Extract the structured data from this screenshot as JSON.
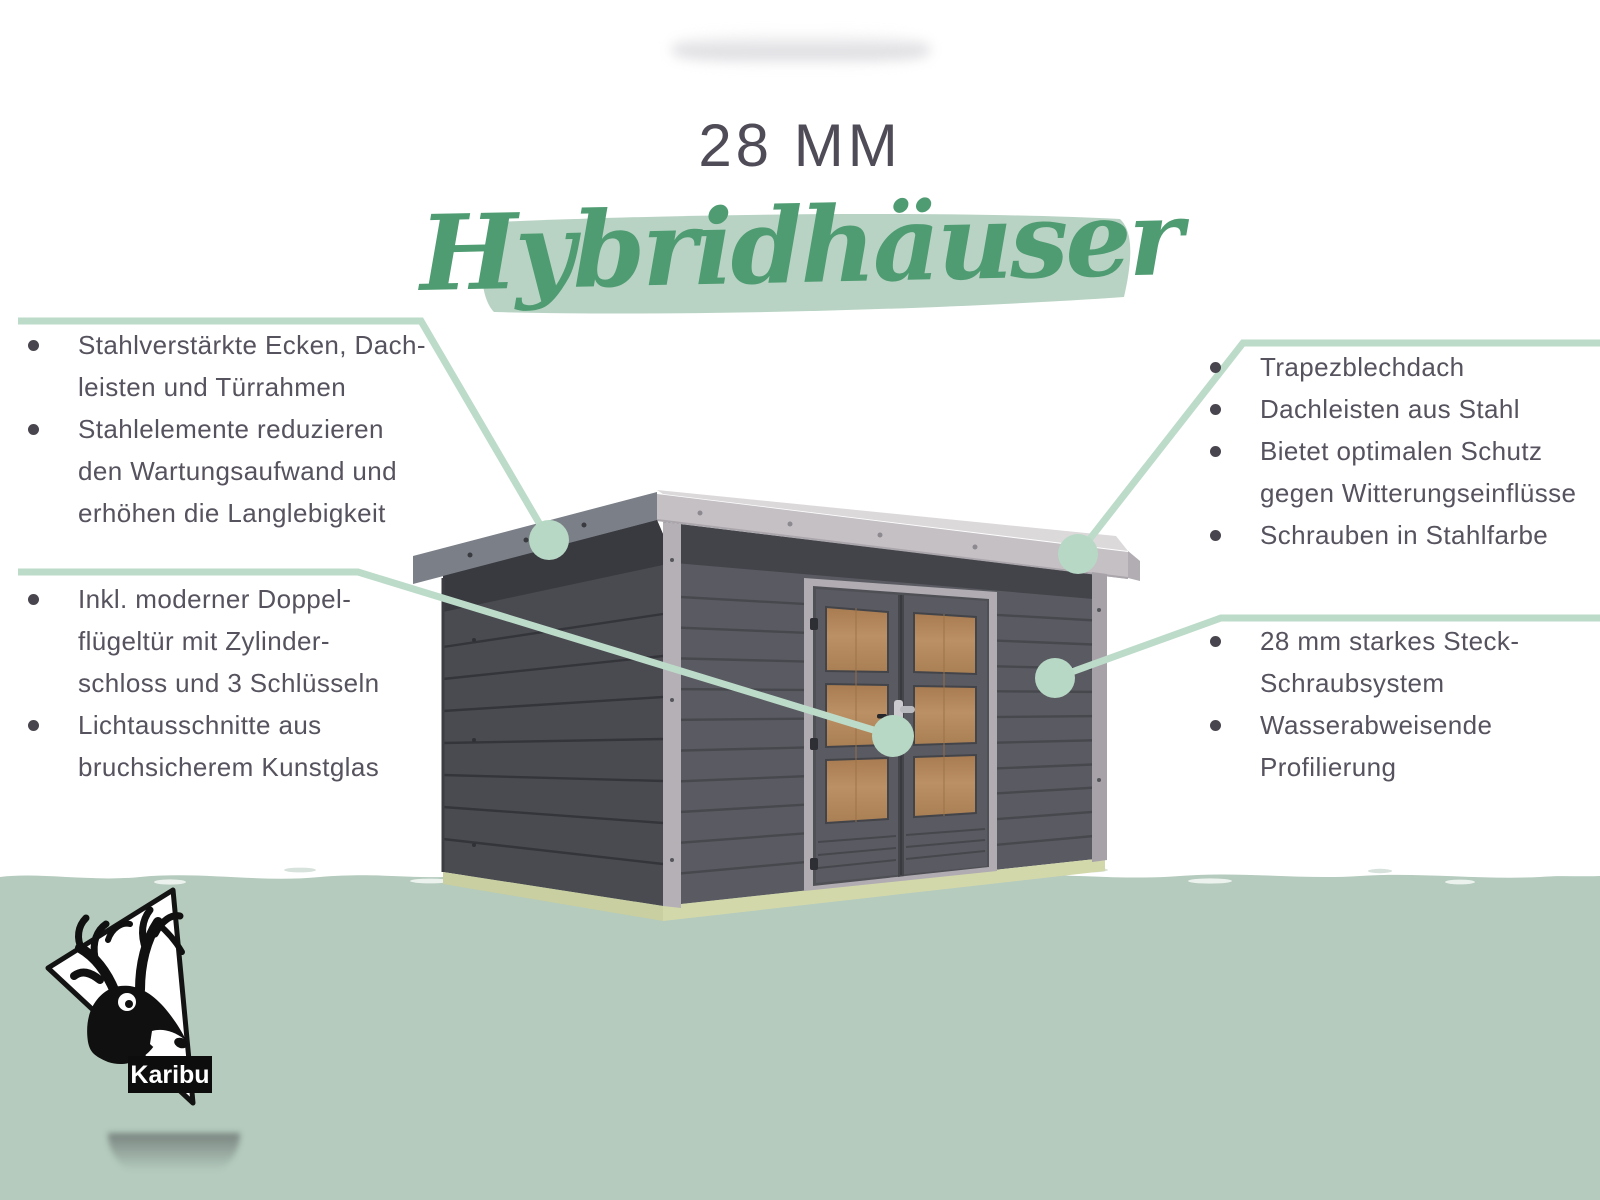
{
  "title": {
    "size_label": "28 MM",
    "product_name": "Hybridhäuser"
  },
  "callouts": {
    "top_left": {
      "items": [
        {
          "lines": [
            "Stahlverstärkte Ecken, Dach-",
            "leisten und Türrahmen"
          ]
        },
        {
          "lines": [
            "Stahlelemente reduzieren",
            "den Wartungsaufwand und",
            "erhöhen die Langlebigkeit"
          ]
        }
      ]
    },
    "bottom_left": {
      "items": [
        {
          "lines": [
            "Inkl. moderner Doppel-",
            "flügeltür mit Zylinder-",
            "schloss und 3 Schlüsseln"
          ]
        },
        {
          "lines": [
            "Lichtausschnitte aus",
            "bruchsicherem Kunstglas"
          ]
        }
      ]
    },
    "top_right": {
      "items": [
        {
          "lines": [
            "Trapezblechdach"
          ]
        },
        {
          "lines": [
            "Dachleisten aus Stahl"
          ]
        },
        {
          "lines": [
            "Bietet optimalen Schutz",
            "gegen Witterungseinflüsse"
          ]
        },
        {
          "lines": [
            "Schrauben in Stahlfarbe"
          ]
        }
      ]
    },
    "bottom_right": {
      "items": [
        {
          "lines": [
            "28 mm starkes Steck-",
            "Schraubsystem"
          ]
        },
        {
          "lines": [
            "Wasserabweisende",
            "Profilierung"
          ]
        }
      ]
    }
  },
  "logo": {
    "label": "Karibu"
  },
  "illustration": {
    "subject": "garden-shed-3d-render",
    "callout_dots": 4
  },
  "colors": {
    "accent_green": "#4f9c72",
    "brush_sage": "#b8d3c4",
    "ground_sage": "#b4cbbd",
    "connector_green": "#bcdbc9",
    "text_gray": "#56525e",
    "wall_dark": "#5a5b62",
    "wall_side": "#4a4b51",
    "roof_light": "#c4c0c4",
    "foundation": "#ccd1a2",
    "door_wood": "#b38a5d"
  }
}
